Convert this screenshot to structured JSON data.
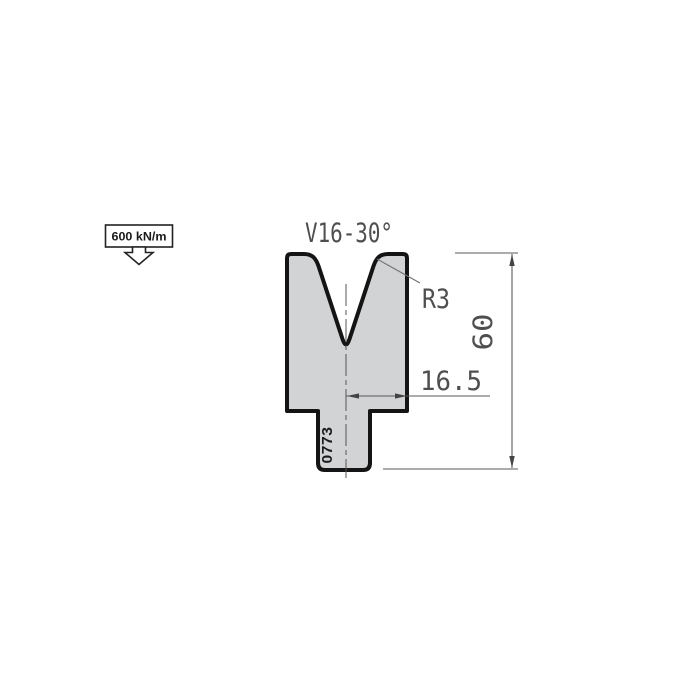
{
  "drawing": {
    "title": "V16-30°",
    "force_label": "600 kN/m",
    "die_id": "0773",
    "dimensions": {
      "total_height": "60",
      "center_to_edge": "16.5",
      "shoulder_radius": "R3"
    },
    "colors": {
      "die_fill": "#d2d3d5",
      "outline_ink": "#141414",
      "dimension_ink": "#4f4f4f",
      "line_ink": "#5a5a5a",
      "label_ink": "#1a1a1a",
      "background": "#ffffff"
    }
  }
}
